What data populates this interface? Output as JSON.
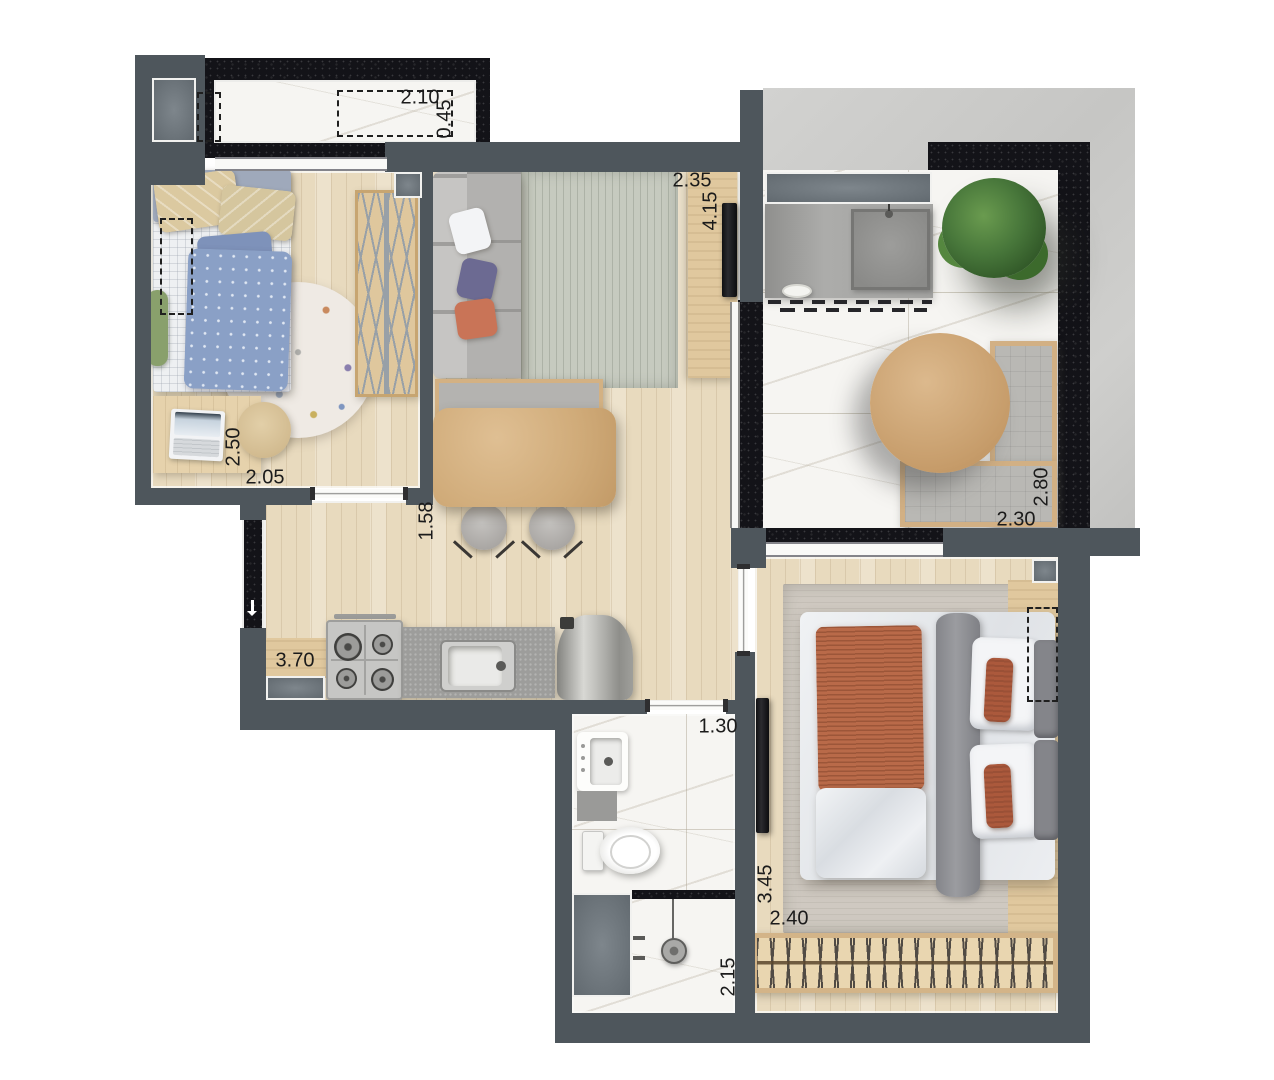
{
  "dimension_labels": {
    "ledge_width": "2.10",
    "ledge_depth": "0.45",
    "living_width": "2.35",
    "living_length": "4.15",
    "bedroom1_length": "2.50",
    "bedroom1_width": "2.05",
    "dining_width": "1.58",
    "balcony_length": "2.80",
    "balcony_width": "2.30",
    "kitchen_length": "3.70",
    "bathroom_width": "1.30",
    "shower_length": "2.15",
    "master_length": "3.45",
    "master_width": "2.40"
  },
  "colors": {
    "wall": "#4e565c",
    "granite": "#131318",
    "marble": "#f6f5f2",
    "wood_floor": "#e8dabe",
    "concrete": "#c9c9c7",
    "furniture_wood": "#d9b98c",
    "counter_gray": "#9d9d9b",
    "sofa_gray": "#b6b5b3",
    "rug_green_gray": "#c6cabf",
    "rug_beige": "#cfc9c1",
    "bed_terracotta": "#b96a49",
    "pillow_orange": "#ab593c",
    "pillow_purple": "#6c6a92",
    "kid_bed_blue": "#8aa0c6",
    "dimension_text": "#1b1b1b"
  }
}
